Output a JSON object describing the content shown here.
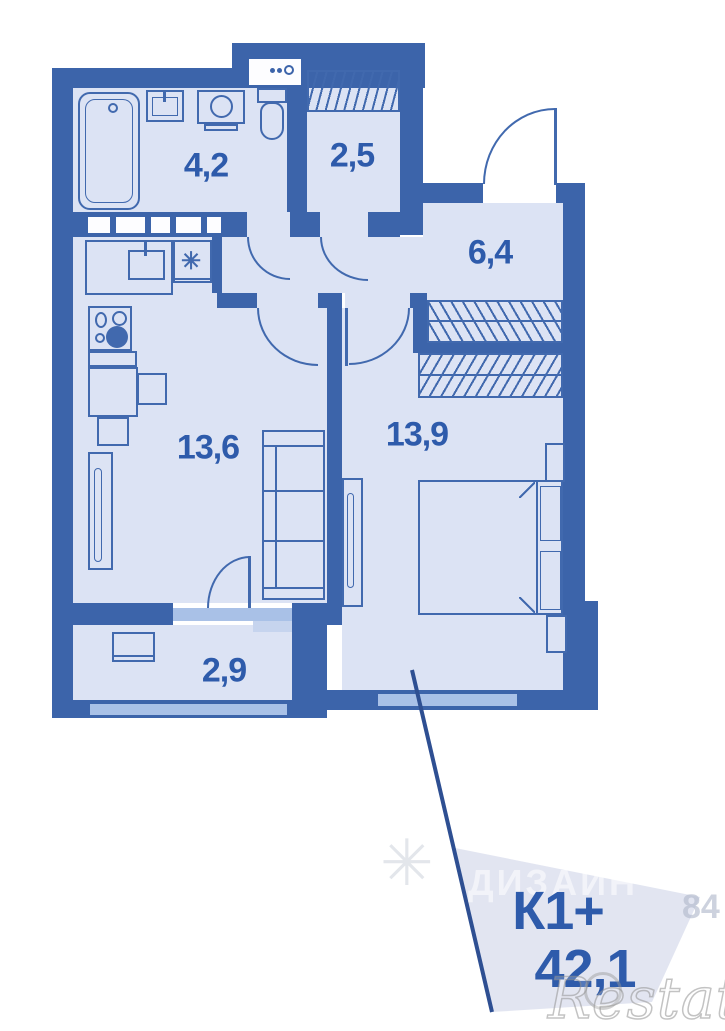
{
  "plan": {
    "rooms": [
      {
        "name": "bathroom",
        "area_label": "4,2"
      },
      {
        "name": "closet",
        "area_label": "2,5"
      },
      {
        "name": "hallway",
        "area_label": "6,4"
      },
      {
        "name": "kitchen-living",
        "area_label": "13,6"
      },
      {
        "name": "bedroom",
        "area_label": "13,9"
      },
      {
        "name": "balcony",
        "area_label": "2,9"
      }
    ],
    "fixtures": [
      "bathtub",
      "bathroom-sink",
      "washing-machine",
      "toilet",
      "shelf",
      "wardrobe",
      "kitchen-sink",
      "gas-stove",
      "counter",
      "tall-cabinet",
      "sofa",
      "double-bed",
      "nightstand",
      "balcony-table"
    ],
    "icons": {
      "vent_symbol": "✳",
      "logo_mark": "✳"
    },
    "callout": {
      "unit_type": "К1+",
      "total_area": "42,1"
    },
    "watermark": {
      "brand": "Restate",
      "ghost_text": "ДИЗАЙН",
      "ghost_number": "84"
    },
    "colors": {
      "wall": "#3c64aa",
      "floor": "#dce3f4",
      "window": "#a9c1e7",
      "label_text": "#2e5bab",
      "leader_line": "#2e4f92",
      "callout_fill": "#dfe3f0"
    }
  }
}
